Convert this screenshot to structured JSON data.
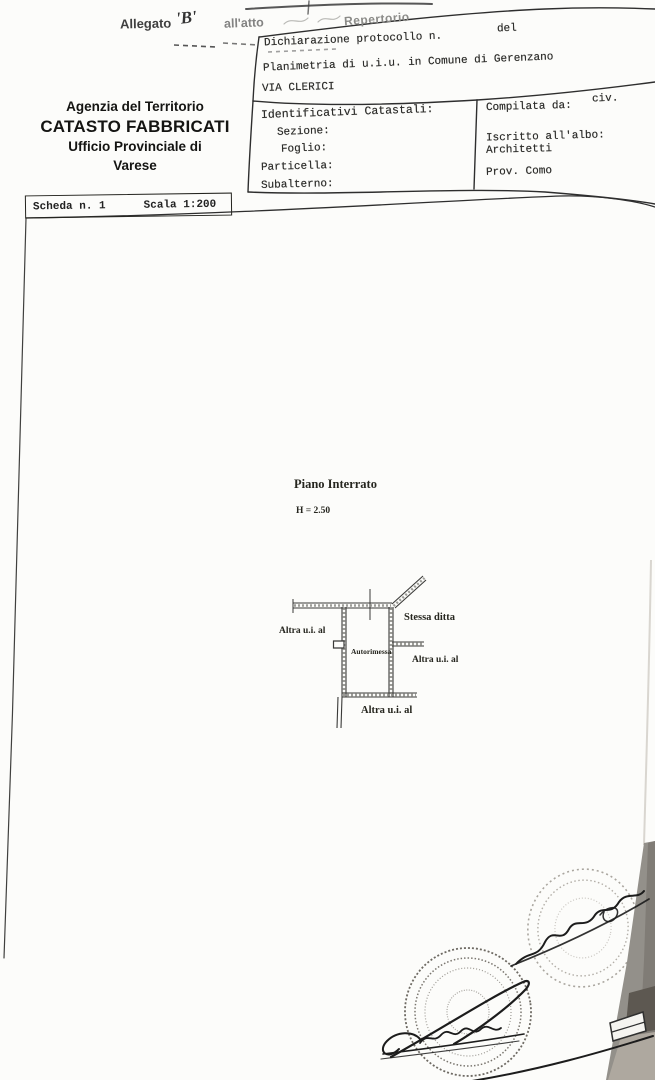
{
  "top_annotation": {
    "allegato": "Allegato",
    "letter": "'B'",
    "allatto": "all'atto",
    "repertorio": "Repertorio"
  },
  "agency": {
    "line1": "Agenzia del Territorio",
    "line2": "CATASTO FABBRICATI",
    "line3": "Ufficio Provinciale di",
    "line4": "Varese"
  },
  "scheda": {
    "number_label": "Scheda n. 1",
    "scale_label": "Scala 1:200"
  },
  "declaration": {
    "protocol": "Dichiarazione protocollo n.",
    "del": "del",
    "planimetria": "Planimetria di u.i.u. in Comune di Gerenzano",
    "street": "VIA CLERICI",
    "civ": "civ."
  },
  "cadastral": {
    "title": "Identificativi Catastali:",
    "sezione": "Sezione:",
    "foglio": "Foglio:",
    "particella": "Particella:",
    "subalterno": "Subalterno:"
  },
  "compiler": {
    "compilata": "Compilata da:",
    "iscritto": "Iscritto all'albo:",
    "albo": "Architetti",
    "prov": "Prov. Como"
  },
  "plan": {
    "floor_label": "Piano Interrato",
    "height_label": "H = 2.50",
    "room_label": "Autorimessa",
    "left_label": "Altra u.i. al",
    "top_right_label": "Stessa ditta",
    "right_label": "Altra u.i. al",
    "bottom_label": "Altra u.i. al"
  },
  "colors": {
    "ink": "#1c1c1c",
    "form_line": "#2e2e2e",
    "stamp_grey": "#8b8780",
    "band_grey": "#93908a"
  }
}
